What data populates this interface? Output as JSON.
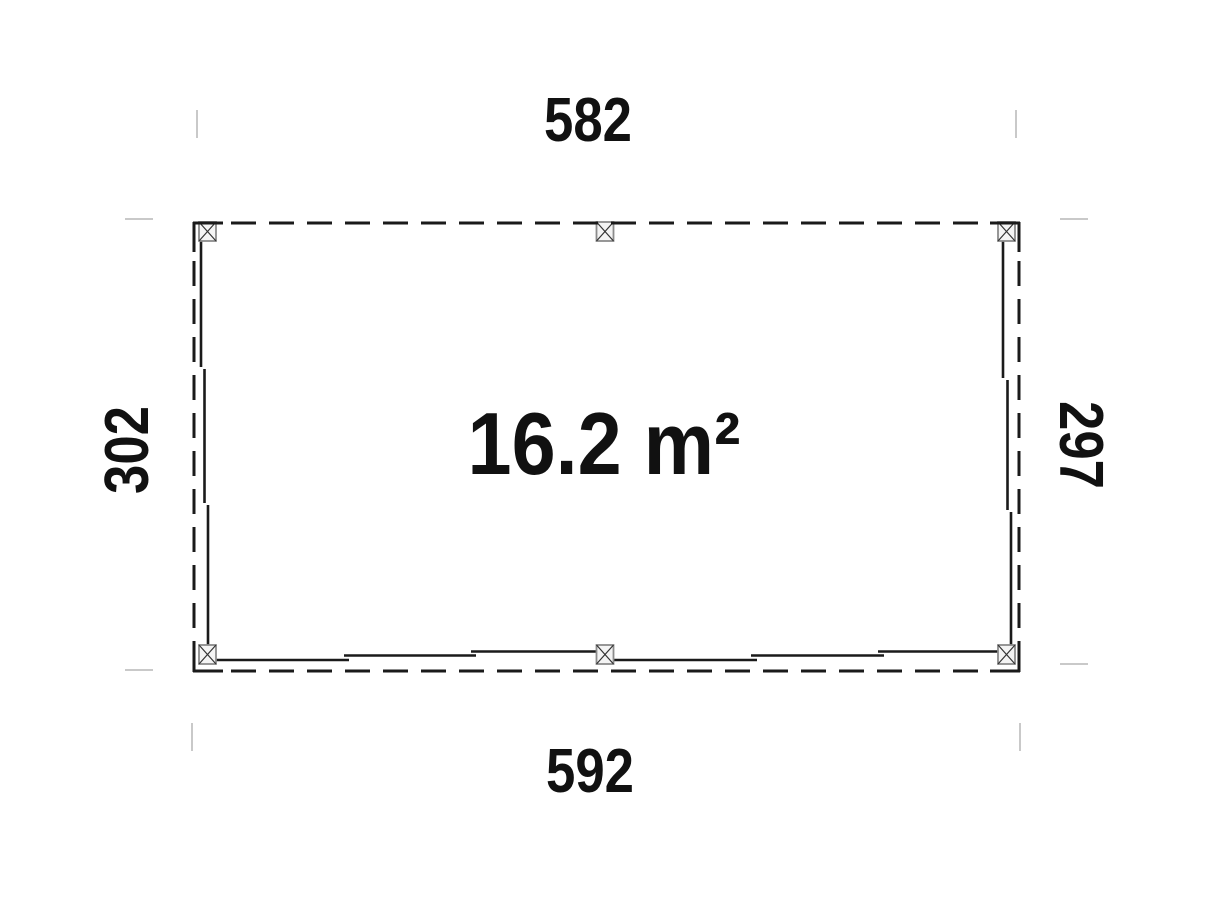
{
  "plan": {
    "type": "floor-plan-top-view",
    "area_label": "16.2 m²",
    "dimensions": {
      "top": "582",
      "bottom": "592",
      "left": "302",
      "right": "297"
    },
    "posts_count": 6,
    "colors": {
      "outline": "#1a1a1a",
      "witness_line": "#c9c9c9",
      "post_fill": "#f4f4f4",
      "post_border": "#8c8c8c",
      "text": "#111111",
      "background": "#ffffff"
    }
  }
}
